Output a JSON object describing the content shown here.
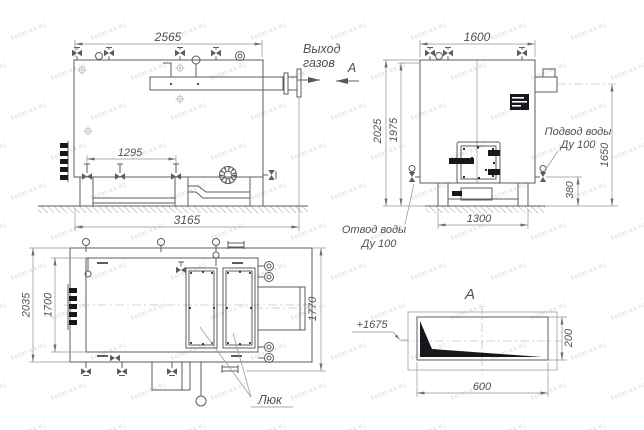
{
  "drawing": {
    "watermark": {
      "text": "kotel-kv.kz",
      "color": "#d3d7de"
    },
    "colors": {
      "line": "#5a5d61",
      "thin_line": "#909399",
      "text": "#4e5155",
      "solid_fill": "#17181c"
    },
    "front_view": {
      "dim_length": "2565",
      "dim_total_length": "3165",
      "dim_valve_spacing": "1295",
      "gas_outlet_line1": "Выход",
      "gas_outlet_line2": "газов",
      "section_arrow_label": "А"
    },
    "side_view": {
      "dim_width": "1600",
      "dim_height_overall": "2025",
      "dim_height_body": "1975",
      "dim_flue_height": "1650",
      "dim_drain_height": "380",
      "dim_leg_span": "1300",
      "water_inlet_line1": "Подвод воды",
      "water_inlet_line2": "Ду 100",
      "water_outlet_line1": "Отвод воды",
      "water_outlet_line2": "Ду 100"
    },
    "plan_view": {
      "dim_depth_overall": "2035",
      "dim_depth_body": "1700",
      "dim_depth_right": "1770",
      "hatch_label": "Люк"
    },
    "section_view": {
      "label": "А",
      "elevation": "+1675",
      "dim_width": "600",
      "dim_height": "200"
    }
  }
}
